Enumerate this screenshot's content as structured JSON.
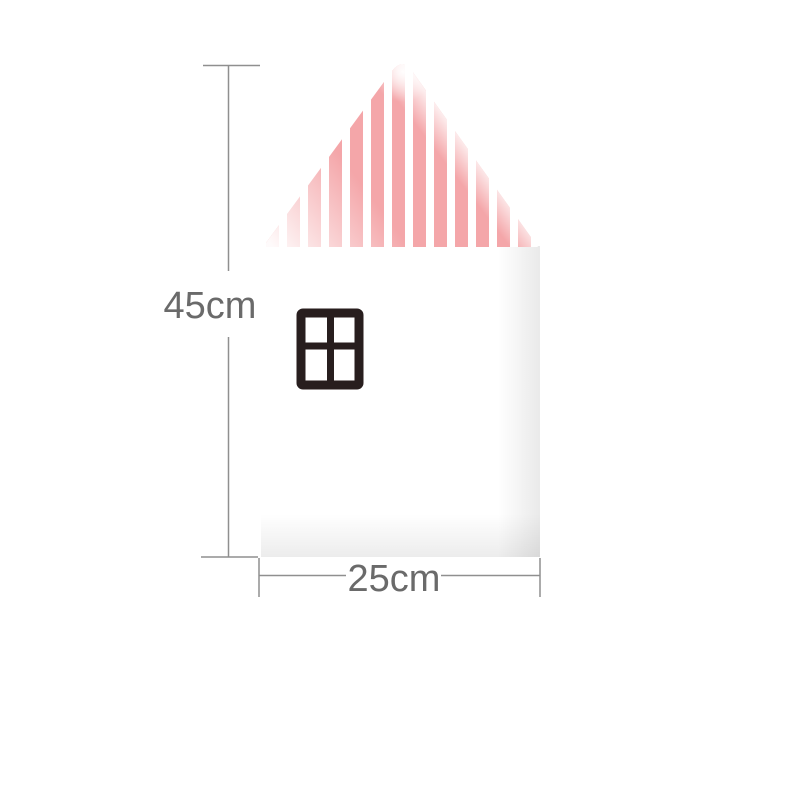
{
  "labels": {
    "height": "45cm",
    "width": "25cm"
  },
  "colors": {
    "background": "#ffffff",
    "stripe_pink": "#f4a6a9",
    "house_white": "#ffffff",
    "window_frame": "#281e1e",
    "dimension_line": "#8f8f8f",
    "label_text": "#6a6a6a"
  }
}
